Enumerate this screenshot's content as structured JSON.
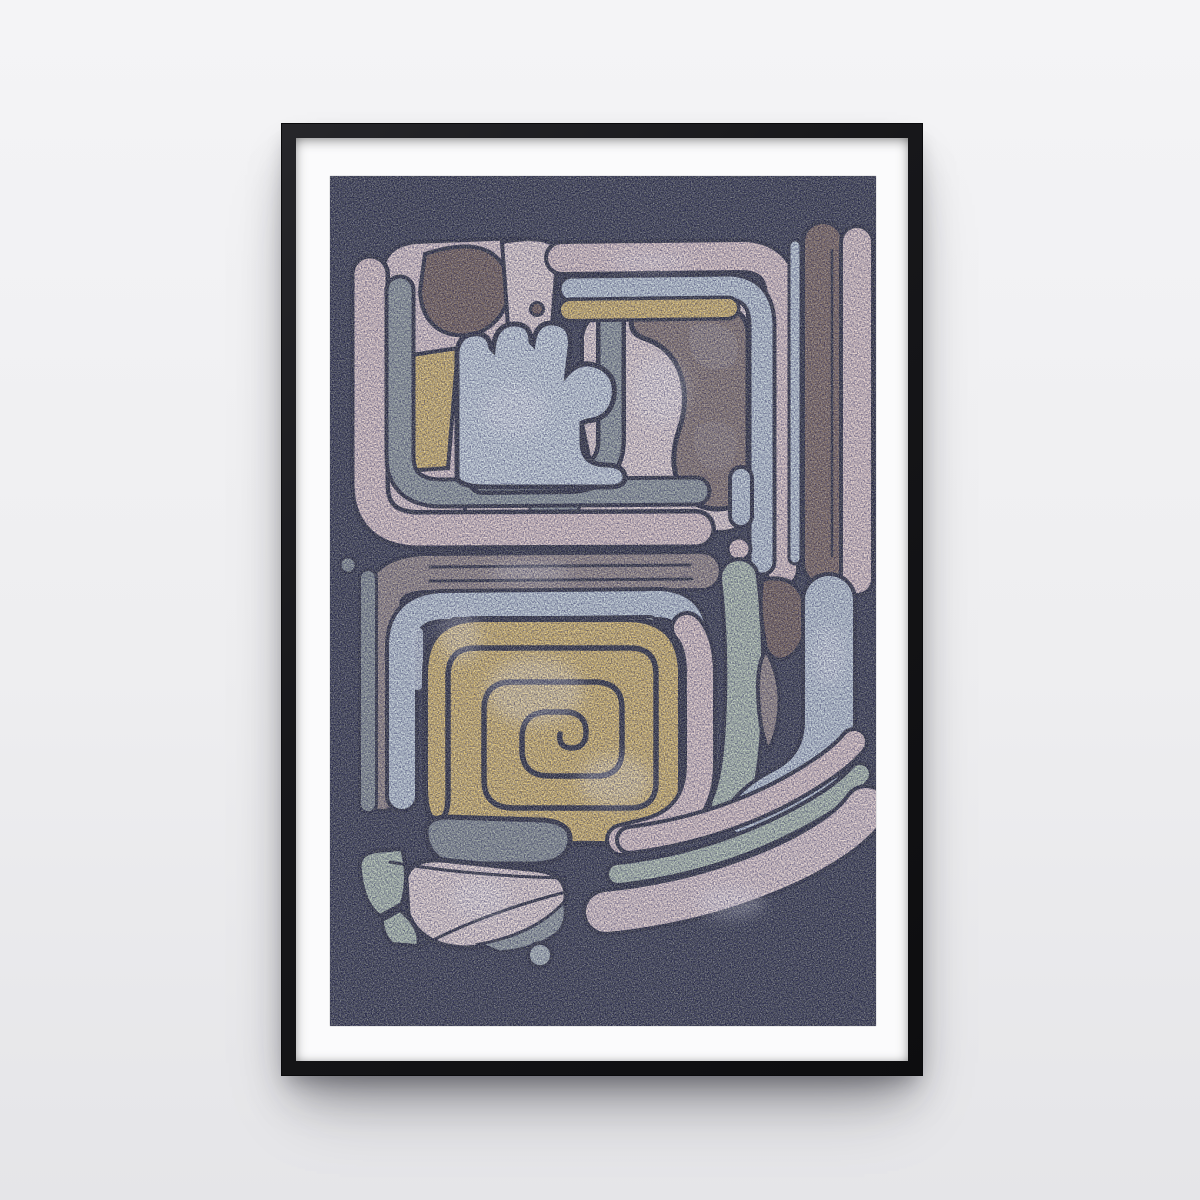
{
  "scene": {
    "description": "Black-framed portrait poster of abstract curvilinear art in pre-Columbian style hanging on a plain light wall",
    "orientation": "portrait",
    "motifs": [
      "rounded-square-face-motif-top",
      "square-spiral-motif-bottom",
      "vertical-stripes-right",
      "pebble-cluster-bottom-left",
      "accent-dots"
    ]
  },
  "palette": {
    "wall_top": "#f4f4f6",
    "wall_mid": "#eeeeF0",
    "wall_bottom": "#e5e5e8",
    "frame": "#17171a",
    "mat": "#fbfbfc",
    "bg": "#3f434b",
    "line": "#34373d",
    "pink": "#e5d0c8",
    "blush": "#e6d3cc",
    "cream": "#ecdcd3",
    "blue": "#c4d2d6",
    "paleblue": "#cfdcdf",
    "yellow": "#dcbf6b",
    "brown": "#84705f",
    "darkbrown": "#7a6757",
    "camo": "#8d7d6e",
    "taupe": "#9c9084",
    "graygreen": "#96a19b",
    "gray": "#8d9792",
    "silver": "#9aa49e",
    "sage": "#b5c5ae",
    "dotblue": "#b3bfba"
  }
}
